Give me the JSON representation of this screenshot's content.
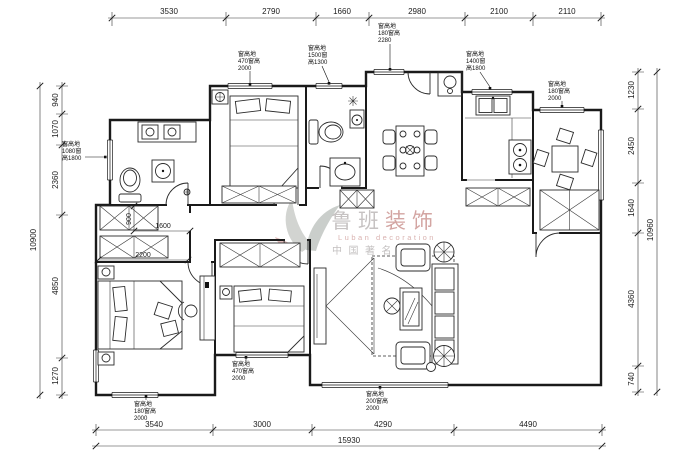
{
  "watermark": {
    "cn1": "鲁班",
    "cn2": "装饰",
    "en": "Luban decoration",
    "tagline": "中国著名品牌",
    "gray": "#b8b4b4",
    "red": "#c98f8c"
  },
  "dims": {
    "top": [
      "3530",
      "2790",
      "1660",
      "2980",
      "2100",
      "2110"
    ],
    "left": [
      "940",
      "1070",
      "2360",
      "4850",
      "1270"
    ],
    "left_total": "10900",
    "right": [
      "1230",
      "2450",
      "1640",
      "4360",
      "740"
    ],
    "right_total": "10960",
    "bottom": [
      "3540",
      "3000",
      "4290",
      "4490"
    ],
    "bottom_total": "15930",
    "inner": {
      "v900": "900",
      "h1600": "1600",
      "h2200": "2200"
    }
  },
  "annotations": {
    "a1": [
      "窗高地",
      "470窗高",
      "2000"
    ],
    "a2": [
      "窗高地",
      "1500窗",
      "高1300"
    ],
    "a3": [
      "窗高地",
      "180窗高",
      "2280"
    ],
    "a4": [
      "窗高地",
      "1400窗",
      "高1800"
    ],
    "a5": [
      "窗高地",
      "180窗高",
      "2000"
    ],
    "a6": [
      "窗高地",
      "1080窗",
      "高1800"
    ],
    "a7": [
      "窗高地",
      "180窗高",
      "2000"
    ],
    "a8": [
      "窗高地",
      "200窗高",
      "2000"
    ],
    "a9": [
      "窗高地",
      "470窗高",
      "2000"
    ]
  }
}
